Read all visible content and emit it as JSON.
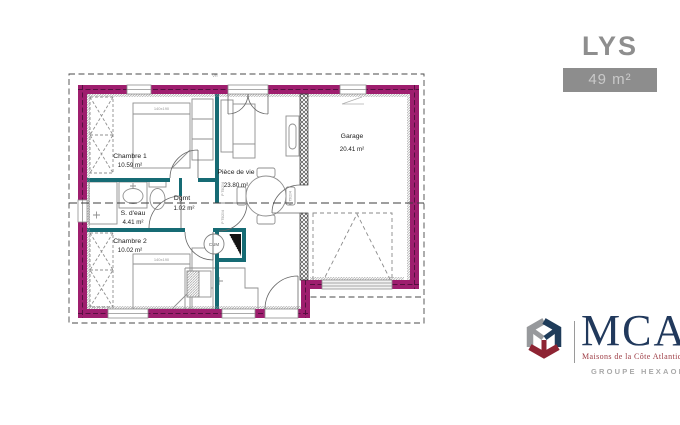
{
  "header": {
    "model_name": "LYS",
    "area_badge": "49 m²"
  },
  "plan": {
    "rooms": {
      "chambre1": {
        "name": "Chambre 1",
        "area": "10.59 m²"
      },
      "sdeau": {
        "name": "S. d'eau",
        "area": "4.41 m²"
      },
      "dgmt": {
        "name": "Dgmt",
        "area": "1.02 m²"
      },
      "chambre2": {
        "name": "Chambre 2",
        "area": "10.02 m²"
      },
      "piece_de_vie": {
        "name": "Pièce de vie",
        "area": "23.80 m²"
      },
      "garage": {
        "name": "Garage",
        "area": "20.41 m²"
      }
    },
    "annotations": {
      "bed_dimensions": "140x190",
      "water_heater": "CUM",
      "door_spec": "P 75/204",
      "roller_shutter": "VR"
    },
    "colors": {
      "exterior_wall": "#9e1e6e",
      "partition_wall": "#166b74"
    }
  },
  "branding": {
    "acronym": "MCA",
    "tagline": "Maisons de la Côte Atlantique",
    "group": "GROUPE HEXAOM"
  }
}
